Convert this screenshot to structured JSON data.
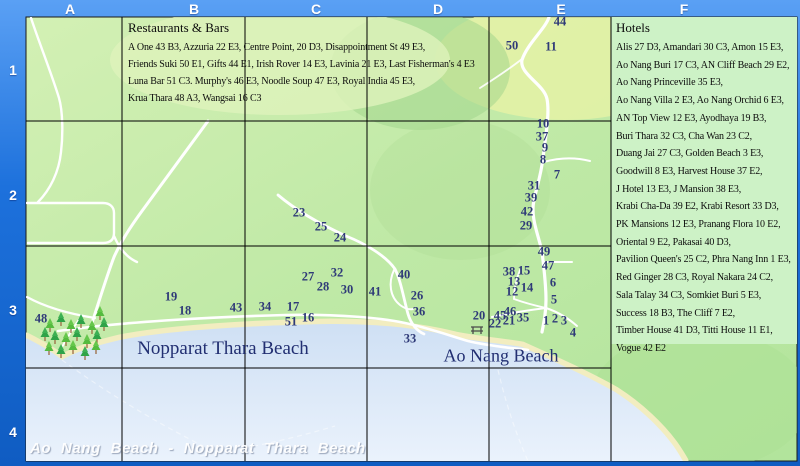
{
  "header": {
    "columns": [
      "A",
      "B",
      "C",
      "D",
      "E",
      "F"
    ],
    "rows": [
      "1",
      "2",
      "3",
      "4"
    ]
  },
  "restaurants": {
    "title": "Restaurants & Bars",
    "lines": [
      "A One 43 B3, Azzuria 22 E3, Centre Point, 20 D3, Disappointment St 49 E3,",
      "Friends Suki 50 E1, Gifts 44 E1, Irish Rover 14 E3, Lavinia 21 E3, Last Fisherman's 4 E3",
      "Luna Bar 51 C3. Murphy's 46 E3, Noodle Soup 47 E3, Royal India 45 E3,",
      "Krua Thara  48 A3, Wangsai  16 C3"
    ]
  },
  "hotels": {
    "title": "Hotels",
    "lines": [
      "Alis 27 D3, Amandari 30 C3, Amon 15 E3,",
      "Ao Nang Buri 17 C3, AN Cliff Beach 29 E2,",
      "Ao Nang Princeville 35 E3,",
      "Ao Nang Villa 2 E3, Ao Nang Orchid 6 E3,",
      "AN Top View 12 E3, Ayodhaya 19 B3,",
      "Buri Thara 32 C3,  Cha Wan 23 C2,",
      "Duang Jai 27 C3,  Golden Beach 3 E3,",
      "Goodwill 8 E3,  Harvest House 37 E2,",
      "J Hotel 13 E3,  J Mansion 38 E3,",
      "Krabi Cha-Da 39 E2, Krabi Resort 33 D3,",
      "PK Mansions 12 E3, Pranang Flora 10 E2,",
      "Oriental 9 E2, Pakasai 40 D3,",
      "Pavilion Queen's 25 C2,  Phra Nang Inn 1 E3,",
      "Red Ginger 28 C3,  Royal Nakara 24 C2,",
      "Sala Talay 34 C3, Somkiet Buri 5 E3,",
      "Success 18 B3, The Cliff  7 E2,",
      "Timber House 41 D3,  Titti House 11 E1,",
      "Vogue 42 E2"
    ]
  },
  "beach_labels": {
    "nopparat": "Nopparat Thara Beach",
    "ao_nang": "Ao Nang Beach"
  },
  "footer_title": "Ao Nang Beach - Nopparat Thara Beach",
  "map": {
    "markers": [
      {
        "n": "44",
        "x": 560,
        "y": 22
      },
      {
        "n": "50",
        "x": 512,
        "y": 46
      },
      {
        "n": "11",
        "x": 551,
        "y": 47
      },
      {
        "n": "10",
        "x": 543,
        "y": 124
      },
      {
        "n": "37",
        "x": 542,
        "y": 137
      },
      {
        "n": "9",
        "x": 545,
        "y": 148
      },
      {
        "n": "8",
        "x": 543,
        "y": 160
      },
      {
        "n": "7",
        "x": 557,
        "y": 175
      },
      {
        "n": "31",
        "x": 534,
        "y": 186
      },
      {
        "n": "39",
        "x": 531,
        "y": 198
      },
      {
        "n": "42",
        "x": 527,
        "y": 212
      },
      {
        "n": "29",
        "x": 526,
        "y": 226
      },
      {
        "n": "23",
        "x": 299,
        "y": 213
      },
      {
        "n": "25",
        "x": 321,
        "y": 227
      },
      {
        "n": "24",
        "x": 340,
        "y": 238
      },
      {
        "n": "27",
        "x": 308,
        "y": 277
      },
      {
        "n": "32",
        "x": 337,
        "y": 273
      },
      {
        "n": "28",
        "x": 323,
        "y": 287
      },
      {
        "n": "30",
        "x": 347,
        "y": 290
      },
      {
        "n": "19",
        "x": 171,
        "y": 297
      },
      {
        "n": "18",
        "x": 185,
        "y": 311
      },
      {
        "n": "43",
        "x": 236,
        "y": 308
      },
      {
        "n": "34",
        "x": 265,
        "y": 307
      },
      {
        "n": "17",
        "x": 293,
        "y": 307
      },
      {
        "n": "51",
        "x": 291,
        "y": 322
      },
      {
        "n": "16",
        "x": 308,
        "y": 318
      },
      {
        "n": "48",
        "x": 41,
        "y": 319
      },
      {
        "n": "40",
        "x": 404,
        "y": 275
      },
      {
        "n": "41",
        "x": 375,
        "y": 292
      },
      {
        "n": "26",
        "x": 417,
        "y": 296
      },
      {
        "n": "36",
        "x": 419,
        "y": 312
      },
      {
        "n": "33",
        "x": 410,
        "y": 339
      },
      {
        "n": "20",
        "x": 479,
        "y": 316
      },
      {
        "n": "49",
        "x": 544,
        "y": 252
      },
      {
        "n": "47",
        "x": 548,
        "y": 266
      },
      {
        "n": "38",
        "x": 509,
        "y": 272
      },
      {
        "n": "15",
        "x": 524,
        "y": 271
      },
      {
        "n": "6",
        "x": 553,
        "y": 283
      },
      {
        "n": "13",
        "x": 514,
        "y": 282
      },
      {
        "n": "12",
        "x": 512,
        "y": 292
      },
      {
        "n": "14",
        "x": 527,
        "y": 288
      },
      {
        "n": "5",
        "x": 554,
        "y": 300
      },
      {
        "n": "45",
        "x": 500,
        "y": 316
      },
      {
        "n": "46",
        "x": 510,
        "y": 312
      },
      {
        "n": "35",
        "x": 523,
        "y": 318
      },
      {
        "n": "21",
        "x": 509,
        "y": 321
      },
      {
        "n": "22",
        "x": 495,
        "y": 324
      },
      {
        "n": "1",
        "x": 546,
        "y": 321
      },
      {
        "n": "2",
        "x": 555,
        "y": 319
      },
      {
        "n": "3",
        "x": 564,
        "y": 321
      },
      {
        "n": "4",
        "x": 573,
        "y": 333
      }
    ],
    "trees": [
      [
        50,
        332
      ],
      [
        61,
        326
      ],
      [
        71,
        333
      ],
      [
        81,
        328
      ],
      [
        92,
        334
      ],
      [
        55,
        344
      ],
      [
        66,
        346
      ],
      [
        77,
        341
      ],
      [
        87,
        348
      ],
      [
        97,
        343
      ],
      [
        49,
        355
      ],
      [
        61,
        358
      ],
      [
        73,
        354
      ],
      [
        85,
        360
      ],
      [
        96,
        354
      ],
      [
        104,
        331
      ],
      [
        100,
        320
      ],
      [
        45,
        341
      ]
    ]
  },
  "colors": {
    "frame_blue": "#1d71dc",
    "land_green": "#bce8a4",
    "sea_blue": "#dbe9f9",
    "sand": "#f2edc0",
    "hotels_bg": "#cdf2c6",
    "marker_text": "#2f3a78",
    "beach_label_text": "#222f72",
    "road": "#ffffff",
    "grid": "#000000"
  }
}
